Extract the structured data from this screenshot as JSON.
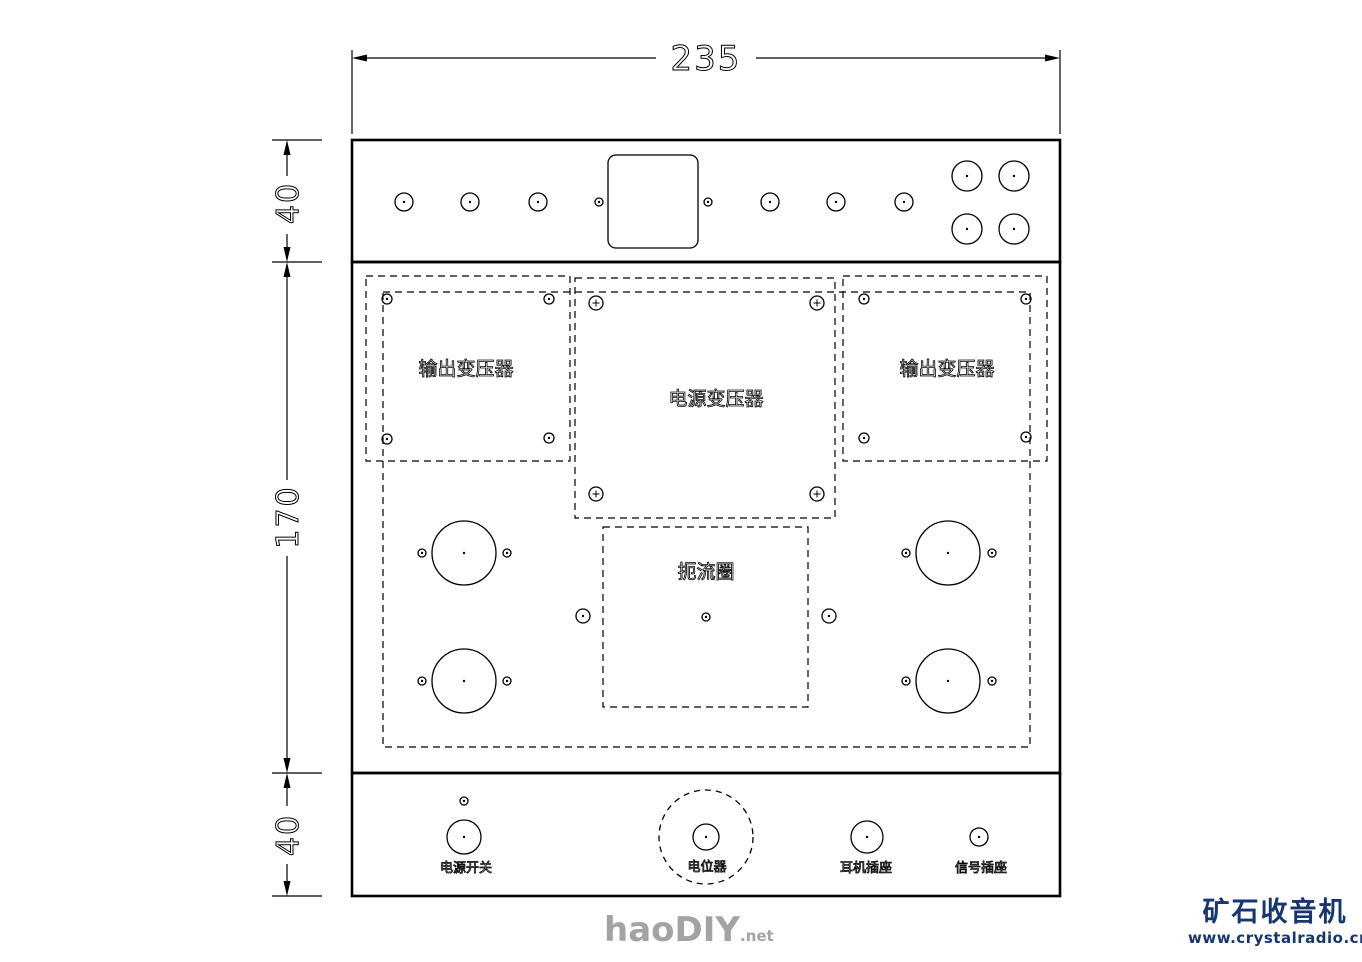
{
  "dimensions": {
    "overall_width": "235",
    "top_panel_height": "40",
    "middle_panel_height": "170",
    "bottom_panel_height": "40"
  },
  "watermark": {
    "big": "haoDIY",
    "small": ".net",
    "color": "#a3a3a3"
  },
  "logo": {
    "line1": "矿石收音机",
    "line2": "www.crystalradio.cn",
    "color": "#17356e"
  },
  "drawing": {
    "rects": [
      {
        "x": 352,
        "y": 140,
        "w": 708,
        "h": 122,
        "sw": 2.6,
        "name": "chassis-top-panel"
      },
      {
        "x": 352,
        "y": 262,
        "w": 708,
        "h": 511,
        "sw": 2.6,
        "name": "chassis-middle-panel"
      },
      {
        "x": 352,
        "y": 773,
        "w": 708,
        "h": 123,
        "sw": 2.6,
        "name": "chassis-bottom-panel"
      },
      {
        "x": 608,
        "y": 155,
        "w": 90,
        "h": 93,
        "rx": 8,
        "sw": 1.3,
        "name": "top-panel-square-cutout"
      },
      {
        "x": 383,
        "y": 292,
        "w": 647,
        "h": 455,
        "dash": true,
        "sw": 1.2,
        "name": "mounting-plate-outline"
      },
      {
        "x": 366,
        "y": 276,
        "w": 204,
        "h": 185,
        "dash": true,
        "sw": 1.2,
        "name": "output-transformer-left-outline"
      },
      {
        "x": 843,
        "y": 276,
        "w": 204,
        "h": 185,
        "dash": true,
        "sw": 1.2,
        "name": "output-transformer-right-outline"
      },
      {
        "x": 575,
        "y": 278,
        "w": 260,
        "h": 240,
        "dash": true,
        "sw": 1.2,
        "name": "power-transformer-outline"
      },
      {
        "x": 603,
        "y": 527,
        "w": 205,
        "h": 180,
        "dash": true,
        "sw": 1.2,
        "name": "choke-outline"
      }
    ],
    "circles": [
      {
        "cx": 404,
        "cy": 202,
        "r": 9,
        "dot": true,
        "name": "top-panel-hole"
      },
      {
        "cx": 470,
        "cy": 202,
        "r": 9,
        "dot": true,
        "name": "top-panel-hole"
      },
      {
        "cx": 538,
        "cy": 202,
        "r": 9,
        "dot": true,
        "name": "top-panel-hole"
      },
      {
        "cx": 599,
        "cy": 202,
        "r": 4,
        "dot": true,
        "name": "top-panel-small-hole"
      },
      {
        "cx": 708,
        "cy": 202,
        "r": 4,
        "dot": true,
        "name": "top-panel-small-hole"
      },
      {
        "cx": 770,
        "cy": 202,
        "r": 9,
        "dot": true,
        "name": "top-panel-hole"
      },
      {
        "cx": 836,
        "cy": 202,
        "r": 9,
        "dot": true,
        "name": "top-panel-hole"
      },
      {
        "cx": 904,
        "cy": 202,
        "r": 9,
        "dot": true,
        "name": "top-panel-hole"
      },
      {
        "cx": 967,
        "cy": 176,
        "r": 15,
        "dot": true,
        "name": "top-panel-large-hole"
      },
      {
        "cx": 1014,
        "cy": 176,
        "r": 15,
        "dot": true,
        "name": "top-panel-large-hole"
      },
      {
        "cx": 967,
        "cy": 229,
        "r": 15,
        "dot": true,
        "name": "top-panel-large-hole"
      },
      {
        "cx": 1014,
        "cy": 229,
        "r": 15,
        "dot": true,
        "name": "top-panel-large-hole"
      },
      {
        "cx": 387,
        "cy": 299,
        "r": 5,
        "dot": true,
        "name": "transformer-mount-hole"
      },
      {
        "cx": 549,
        "cy": 299,
        "r": 5,
        "dot": true,
        "name": "transformer-mount-hole"
      },
      {
        "cx": 387,
        "cy": 439,
        "r": 5,
        "dot": true,
        "name": "transformer-mount-hole"
      },
      {
        "cx": 549,
        "cy": 438,
        "r": 5,
        "dot": true,
        "name": "transformer-mount-hole"
      },
      {
        "cx": 864,
        "cy": 299,
        "r": 5,
        "dot": true,
        "name": "transformer-mount-hole"
      },
      {
        "cx": 1026,
        "cy": 299,
        "r": 5,
        "dot": true,
        "name": "transformer-mount-hole"
      },
      {
        "cx": 864,
        "cy": 438,
        "r": 5,
        "dot": true,
        "name": "transformer-mount-hole"
      },
      {
        "cx": 1026,
        "cy": 437,
        "r": 5,
        "dot": true,
        "name": "transformer-mount-hole"
      },
      {
        "cx": 596,
        "cy": 303,
        "r": 7,
        "cross": true,
        "name": "power-transformer-mount-hole"
      },
      {
        "cx": 817,
        "cy": 303,
        "r": 7,
        "cross": true,
        "name": "power-transformer-mount-hole"
      },
      {
        "cx": 596,
        "cy": 494,
        "r": 7,
        "cross": true,
        "name": "power-transformer-mount-hole"
      },
      {
        "cx": 817,
        "cy": 494,
        "r": 7,
        "cross": true,
        "name": "power-transformer-mount-hole"
      },
      {
        "cx": 706,
        "cy": 617,
        "r": 4,
        "dot": true,
        "name": "choke-center-hole"
      },
      {
        "cx": 583,
        "cy": 616,
        "r": 7,
        "dot": true,
        "name": "plate-hole"
      },
      {
        "cx": 829,
        "cy": 616,
        "r": 7,
        "dot": true,
        "name": "plate-hole"
      },
      {
        "cx": 464,
        "cy": 553,
        "r": 32,
        "dot": true,
        "name": "tube-socket-hole"
      },
      {
        "cx": 464,
        "cy": 681,
        "r": 32,
        "dot": true,
        "name": "tube-socket-hole"
      },
      {
        "cx": 948,
        "cy": 553,
        "r": 32,
        "dot": true,
        "name": "tube-socket-hole"
      },
      {
        "cx": 948,
        "cy": 681,
        "r": 32,
        "dot": true,
        "name": "tube-socket-hole"
      },
      {
        "cx": 422,
        "cy": 553,
        "r": 4,
        "dot": true,
        "name": "tube-mount-hole"
      },
      {
        "cx": 507,
        "cy": 553,
        "r": 4,
        "dot": true,
        "name": "tube-mount-hole"
      },
      {
        "cx": 422,
        "cy": 681,
        "r": 4,
        "dot": true,
        "name": "tube-mount-hole"
      },
      {
        "cx": 507,
        "cy": 681,
        "r": 4,
        "dot": true,
        "name": "tube-mount-hole"
      },
      {
        "cx": 906,
        "cy": 553,
        "r": 4,
        "dot": true,
        "name": "tube-mount-hole"
      },
      {
        "cx": 992,
        "cy": 553,
        "r": 4,
        "dot": true,
        "name": "tube-mount-hole"
      },
      {
        "cx": 906,
        "cy": 681,
        "r": 4,
        "dot": true,
        "name": "tube-mount-hole"
      },
      {
        "cx": 992,
        "cy": 681,
        "r": 4,
        "dot": true,
        "name": "tube-mount-hole"
      },
      {
        "cx": 464,
        "cy": 801,
        "r": 4,
        "dot": true,
        "name": "bottom-panel-small-hole"
      },
      {
        "cx": 464,
        "cy": 837,
        "r": 17,
        "dot": true,
        "name": "power-switch-hole"
      },
      {
        "cx": 706,
        "cy": 837,
        "r": 47,
        "dash": true,
        "name": "potentiometer-body-outline"
      },
      {
        "cx": 706,
        "cy": 837,
        "r": 13,
        "dot": true,
        "name": "potentiometer-hole"
      },
      {
        "cx": 867,
        "cy": 837,
        "r": 16,
        "dot": true,
        "name": "headphone-jack-hole"
      },
      {
        "cx": 979,
        "cy": 837,
        "r": 9,
        "dot": true,
        "name": "signal-jack-hole"
      }
    ],
    "lines": [
      {
        "x1": 352,
        "y1": 50,
        "x2": 352,
        "y2": 134,
        "name": "extension-line"
      },
      {
        "x1": 1060,
        "y1": 50,
        "x2": 1060,
        "y2": 134,
        "name": "extension-line"
      },
      {
        "x1": 366,
        "y1": 58,
        "x2": 656,
        "y2": 58,
        "name": "dim-line-235"
      },
      {
        "x1": 756,
        "y1": 58,
        "x2": 1046,
        "y2": 58,
        "name": "dim-line-235"
      },
      {
        "x1": 272,
        "y1": 140,
        "x2": 322,
        "y2": 140,
        "name": "extension-tick"
      },
      {
        "x1": 272,
        "y1": 262,
        "x2": 322,
        "y2": 262,
        "name": "extension-tick"
      },
      {
        "x1": 272,
        "y1": 773,
        "x2": 322,
        "y2": 773,
        "name": "extension-tick"
      },
      {
        "x1": 272,
        "y1": 896,
        "x2": 322,
        "y2": 896,
        "name": "extension-tick"
      },
      {
        "x1": 287,
        "y1": 154,
        "x2": 287,
        "y2": 176,
        "name": "dim-line-40-top"
      },
      {
        "x1": 287,
        "y1": 234,
        "x2": 287,
        "y2": 248,
        "name": "dim-line-40-top"
      },
      {
        "x1": 287,
        "y1": 276,
        "x2": 287,
        "y2": 480,
        "name": "dim-line-170"
      },
      {
        "x1": 287,
        "y1": 556,
        "x2": 287,
        "y2": 759,
        "name": "dim-line-170"
      },
      {
        "x1": 287,
        "y1": 787,
        "x2": 287,
        "y2": 806,
        "name": "dim-line-40-bottom"
      },
      {
        "x1": 287,
        "y1": 864,
        "x2": 287,
        "y2": 882,
        "name": "dim-line-40-bottom"
      }
    ],
    "polys": [
      {
        "pts": "352,58 367,54.5 367,61.5",
        "name": "arrowhead"
      },
      {
        "pts": "1060,58 1045,54.5 1045,61.5",
        "name": "arrowhead"
      },
      {
        "pts": "287,140 283.5,155 290.5,155",
        "name": "arrowhead"
      },
      {
        "pts": "287,262 283.5,247 290.5,247",
        "name": "arrowhead"
      },
      {
        "pts": "287,262 283.5,277 290.5,277",
        "name": "arrowhead"
      },
      {
        "pts": "287,773 283.5,758 290.5,758",
        "name": "arrowhead"
      },
      {
        "pts": "287,773 283.5,788 290.5,788",
        "name": "arrowhead"
      },
      {
        "pts": "287,896 283.5,881 290.5,881",
        "name": "arrowhead"
      }
    ],
    "texts": [
      {
        "t": "235",
        "x": 706,
        "y": 70,
        "size": 34,
        "cls": "dimtxt",
        "name": "dim-value-width"
      },
      {
        "t": "40",
        "x": 298,
        "y": 203,
        "size": 30,
        "rot": -90,
        "cls": "dimtxt",
        "name": "dim-value-top-height"
      },
      {
        "t": "170",
        "x": 298,
        "y": 517,
        "size": 30,
        "rot": -90,
        "cls": "dimtxt",
        "name": "dim-value-middle-height"
      },
      {
        "t": "40",
        "x": 298,
        "y": 835,
        "size": 30,
        "rot": -90,
        "cls": "dimtxt",
        "name": "dim-value-bottom-height"
      },
      {
        "t": "输出变压器",
        "x": 466,
        "y": 375,
        "size": 19,
        "cls": "cadtxt",
        "name": "label-output-transformer-left"
      },
      {
        "t": "电源变压器",
        "x": 716,
        "y": 405,
        "size": 19,
        "cls": "cadtxt",
        "name": "label-power-transformer"
      },
      {
        "t": "输出变压器",
        "x": 947,
        "y": 375,
        "size": 19,
        "cls": "cadtxt",
        "name": "label-output-transformer-right"
      },
      {
        "t": "扼流圈",
        "x": 706,
        "y": 578,
        "size": 19,
        "cls": "cadtxt",
        "name": "label-choke"
      },
      {
        "t": "电源开关",
        "x": 466,
        "y": 872,
        "size": 13,
        "cls": "cadtxt",
        "name": "label-power-switch"
      },
      {
        "t": "电位器",
        "x": 707,
        "y": 871,
        "size": 13,
        "cls": "cadtxt",
        "name": "label-potentiometer"
      },
      {
        "t": "耳机插座",
        "x": 866,
        "y": 872,
        "size": 13,
        "cls": "cadtxt",
        "name": "label-headphone-jack"
      },
      {
        "t": "信号插座",
        "x": 981,
        "y": 872,
        "size": 13,
        "cls": "cadtxt",
        "name": "label-signal-jack"
      }
    ]
  }
}
